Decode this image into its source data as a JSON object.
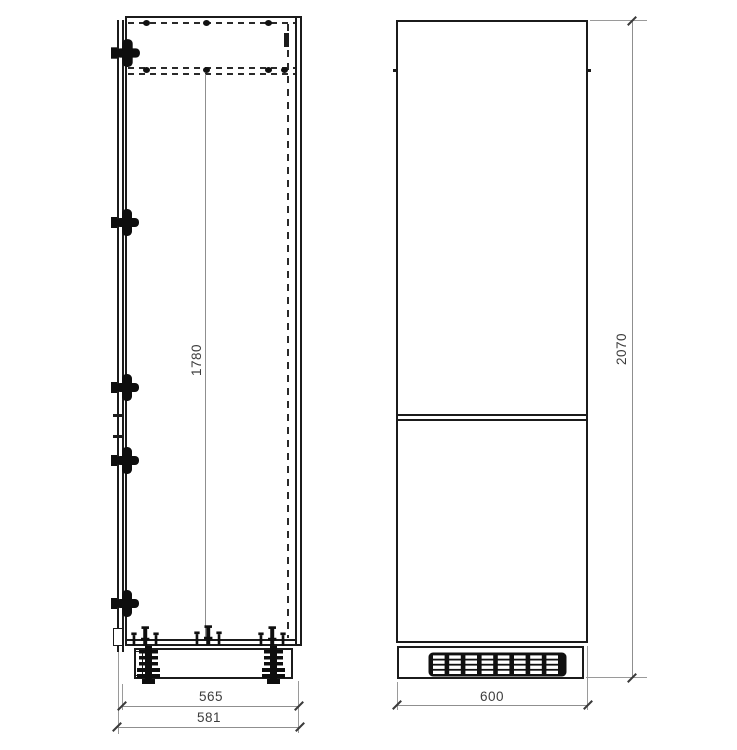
{
  "drawing": {
    "side_view": {
      "interior_height": "1780",
      "carcass_depth": "565",
      "total_depth": "581"
    },
    "front_view": {
      "width": "600",
      "total_height": "2070",
      "vent_grille": {
        "columns": 8,
        "rows": 4
      }
    },
    "colors": {
      "outline": "#1b1b1b",
      "dimension_line": "#8f8f8f",
      "dimension_text": "#3d3d3d",
      "background": "#ffffff"
    }
  }
}
